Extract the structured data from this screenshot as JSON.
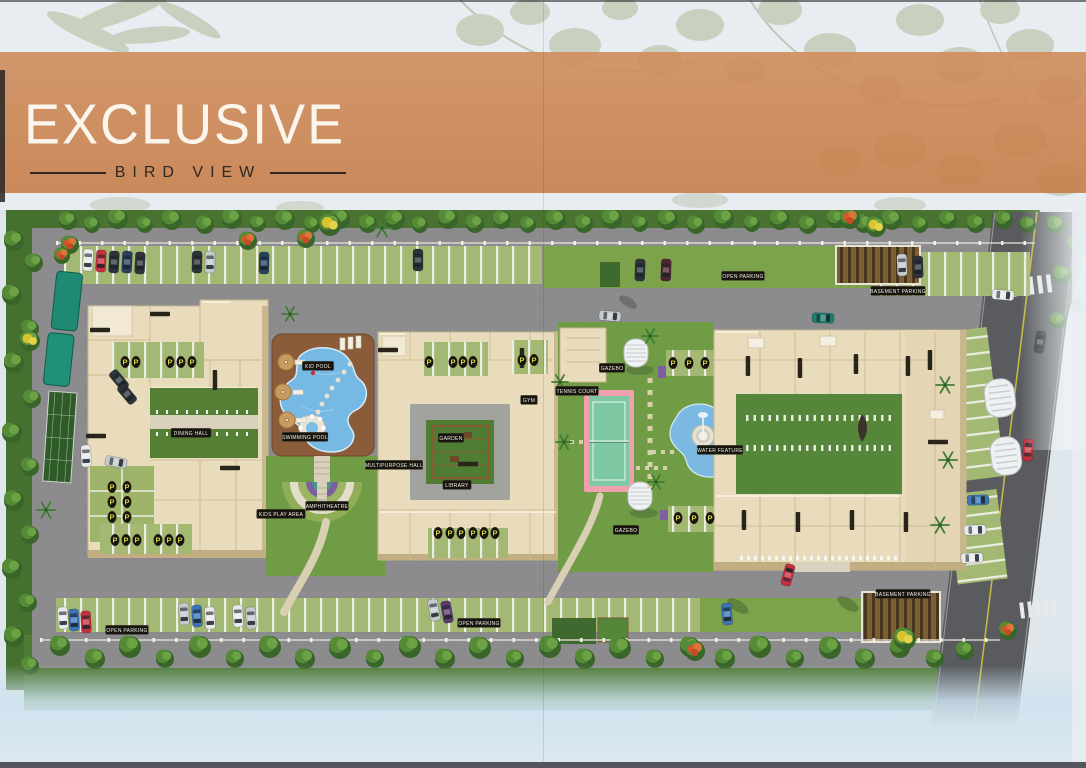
{
  "banner": {
    "title": "EXCLUSIVE",
    "subtitle": "BIRD VIEW"
  },
  "colors": {
    "banner_orange": "#cc8454",
    "label_bg": "#17150e",
    "parking_letter": "#d6d23f",
    "pool_blue": "#74b9e6",
    "lawn_green": "#6f9c45",
    "road_gray": "#595b5e",
    "pavement_gray": "#8d8d8f",
    "building_tan": "#e9dcbd"
  },
  "siteplan": {
    "parking_glyph": "P",
    "labels": [
      {
        "text": "OPEN PARKING",
        "x": 743,
        "y": 66
      },
      {
        "text": "BASEMENT PARKING",
        "x": 898,
        "y": 81
      },
      {
        "text": "OPEN PARKING",
        "x": 127,
        "y": 420
      },
      {
        "text": "OPEN PARKING",
        "x": 479,
        "y": 413
      },
      {
        "text": "BASEMENT PARKING",
        "x": 903,
        "y": 384
      },
      {
        "text": "KID POOL",
        "x": 318,
        "y": 156
      },
      {
        "text": "SWIMMING POOL",
        "x": 305,
        "y": 227
      },
      {
        "text": "AMPHITHEATRE",
        "x": 327,
        "y": 296
      },
      {
        "text": "KIDS PLAY AREA",
        "x": 281,
        "y": 304
      },
      {
        "text": "DINING HALL",
        "x": 191,
        "y": 223
      },
      {
        "text": "GARDEN",
        "x": 451,
        "y": 228
      },
      {
        "text": "GYM",
        "x": 529,
        "y": 190
      },
      {
        "text": "LIBRARY",
        "x": 457,
        "y": 275
      },
      {
        "text": "MULTIPURPOSE HALL",
        "x": 394,
        "y": 255
      },
      {
        "text": "TENNIS COURT",
        "x": 577,
        "y": 181
      },
      {
        "text": "GAZEBO",
        "x": 612,
        "y": 158
      },
      {
        "text": "GAZEBO",
        "x": 626,
        "y": 320
      },
      {
        "text": "WATER FEATURE",
        "x": 720,
        "y": 240
      }
    ],
    "p_markers": [
      [
        125,
        152
      ],
      [
        136,
        152
      ],
      [
        170,
        152
      ],
      [
        181,
        152
      ],
      [
        192,
        152
      ],
      [
        112,
        277
      ],
      [
        127,
        277
      ],
      [
        112,
        292
      ],
      [
        127,
        292
      ],
      [
        112,
        307
      ],
      [
        127,
        307
      ],
      [
        115,
        330
      ],
      [
        126,
        330
      ],
      [
        137,
        330
      ],
      [
        158,
        330
      ],
      [
        169,
        330
      ],
      [
        180,
        330
      ],
      [
        429,
        152
      ],
      [
        453,
        152
      ],
      [
        463,
        152
      ],
      [
        473,
        152
      ],
      [
        522,
        150
      ],
      [
        534,
        150
      ],
      [
        438,
        323
      ],
      [
        450,
        323
      ],
      [
        461,
        323
      ],
      [
        473,
        323
      ],
      [
        484,
        323
      ],
      [
        495,
        323
      ],
      [
        673,
        153
      ],
      [
        689,
        153
      ],
      [
        705,
        153
      ],
      [
        678,
        308
      ],
      [
        694,
        308
      ],
      [
        710,
        308
      ]
    ],
    "cars": [
      [
        88,
        50,
        183,
        "w"
      ],
      [
        101,
        51,
        183,
        "r"
      ],
      [
        114,
        52,
        183,
        "d"
      ],
      [
        127,
        52,
        183,
        "n"
      ],
      [
        140,
        53,
        183,
        "d"
      ],
      [
        197,
        52,
        181,
        "d"
      ],
      [
        210,
        52,
        181,
        "s"
      ],
      [
        264,
        53,
        181,
        "n"
      ],
      [
        418,
        50,
        180,
        "d"
      ],
      [
        640,
        60,
        182,
        "d"
      ],
      [
        666,
        60,
        182,
        "m"
      ],
      [
        902,
        55,
        178,
        "s"
      ],
      [
        918,
        57,
        178,
        "d"
      ],
      [
        1003,
        85,
        95,
        "w"
      ],
      [
        86,
        246,
        178,
        "w"
      ],
      [
        116,
        252,
        100,
        "s"
      ],
      [
        119,
        170,
        140,
        "d"
      ],
      [
        127,
        184,
        140,
        "d"
      ],
      [
        610,
        106,
        95,
        "s"
      ],
      [
        823,
        108,
        92,
        "t"
      ],
      [
        63,
        408,
        177,
        "w"
      ],
      [
        74,
        410,
        177,
        "b"
      ],
      [
        86,
        412,
        177,
        "r"
      ],
      [
        184,
        404,
        177,
        "s"
      ],
      [
        197,
        406,
        177,
        "b"
      ],
      [
        210,
        408,
        177,
        "w"
      ],
      [
        238,
        406,
        177,
        "w"
      ],
      [
        251,
        408,
        177,
        "s"
      ],
      [
        434,
        400,
        170,
        "s"
      ],
      [
        447,
        402,
        170,
        "p"
      ],
      [
        727,
        404,
        175,
        "b"
      ],
      [
        978,
        290,
        88,
        "b"
      ],
      [
        975,
        320,
        88,
        "w"
      ],
      [
        972,
        348,
        88,
        "w"
      ],
      [
        1040,
        132,
        8,
        "d"
      ],
      [
        1028,
        240,
        5,
        "r"
      ],
      [
        788,
        365,
        15,
        "r"
      ]
    ],
    "trees": [
      [
        68,
        10,
        9,
        "g"
      ],
      [
        92,
        14,
        8,
        "g"
      ],
      [
        118,
        8,
        10,
        "g"
      ],
      [
        145,
        14,
        8,
        "g"
      ],
      [
        172,
        9,
        10,
        "g"
      ],
      [
        205,
        14,
        9,
        "g"
      ],
      [
        232,
        8,
        10,
        "g"
      ],
      [
        258,
        13,
        8,
        "g"
      ],
      [
        285,
        9,
        10,
        "g"
      ],
      [
        312,
        14,
        8,
        "g"
      ],
      [
        340,
        8,
        10,
        "g"
      ],
      [
        368,
        13,
        9,
        "g"
      ],
      [
        395,
        9,
        10,
        "g"
      ],
      [
        420,
        14,
        8,
        "g"
      ],
      [
        448,
        8,
        10,
        "g"
      ],
      [
        475,
        13,
        9,
        "g"
      ],
      [
        502,
        9,
        9,
        "g"
      ],
      [
        528,
        14,
        8,
        "g"
      ],
      [
        556,
        9,
        10,
        "g"
      ],
      [
        584,
        13,
        9,
        "g"
      ],
      [
        612,
        8,
        10,
        "g"
      ],
      [
        640,
        13,
        8,
        "g"
      ],
      [
        668,
        9,
        10,
        "g"
      ],
      [
        696,
        14,
        9,
        "g"
      ],
      [
        724,
        8,
        10,
        "g"
      ],
      [
        752,
        13,
        8,
        "g"
      ],
      [
        780,
        9,
        10,
        "g"
      ],
      [
        808,
        14,
        9,
        "g"
      ],
      [
        836,
        8,
        9,
        "g"
      ],
      [
        864,
        13,
        9,
        "g"
      ],
      [
        892,
        9,
        10,
        "g"
      ],
      [
        920,
        14,
        8,
        "g"
      ],
      [
        948,
        9,
        9,
        "g"
      ],
      [
        976,
        13,
        9,
        "g"
      ],
      [
        1004,
        9,
        9,
        "g"
      ],
      [
        1028,
        14,
        8,
        "g"
      ],
      [
        70,
        34,
        9,
        "o"
      ],
      [
        248,
        30,
        9,
        "o"
      ],
      [
        306,
        28,
        9,
        "o"
      ],
      [
        850,
        8,
        10,
        "o"
      ],
      [
        62,
        45,
        8,
        "o"
      ],
      [
        330,
        14,
        11,
        "y"
      ],
      [
        876,
        16,
        10,
        "y"
      ],
      [
        382,
        18,
        10,
        "p"
      ],
      [
        14,
        30,
        10,
        "g"
      ],
      [
        34,
        52,
        9,
        "g"
      ],
      [
        12,
        84,
        10,
        "g"
      ],
      [
        30,
        118,
        9,
        "g"
      ],
      [
        14,
        152,
        10,
        "g"
      ],
      [
        32,
        188,
        9,
        "g"
      ],
      [
        12,
        222,
        10,
        "g"
      ],
      [
        30,
        256,
        9,
        "g"
      ],
      [
        14,
        290,
        10,
        "g"
      ],
      [
        30,
        324,
        9,
        "g"
      ],
      [
        12,
        358,
        10,
        "g"
      ],
      [
        28,
        392,
        9,
        "g"
      ],
      [
        14,
        426,
        10,
        "g"
      ],
      [
        30,
        455,
        9,
        "g"
      ],
      [
        30,
        130,
        10,
        "y"
      ],
      [
        46,
        300,
        9,
        "p"
      ],
      [
        60,
        435,
        10,
        "g"
      ],
      [
        95,
        448,
        10,
        "g"
      ],
      [
        130,
        436,
        11,
        "g"
      ],
      [
        165,
        448,
        9,
        "g"
      ],
      [
        200,
        436,
        11,
        "g"
      ],
      [
        235,
        448,
        9,
        "g"
      ],
      [
        270,
        436,
        11,
        "g"
      ],
      [
        305,
        448,
        10,
        "g"
      ],
      [
        340,
        437,
        11,
        "g"
      ],
      [
        375,
        448,
        9,
        "g"
      ],
      [
        410,
        436,
        11,
        "g"
      ],
      [
        445,
        448,
        10,
        "g"
      ],
      [
        480,
        437,
        11,
        "g"
      ],
      [
        515,
        448,
        9,
        "g"
      ],
      [
        550,
        436,
        11,
        "g"
      ],
      [
        585,
        448,
        10,
        "g"
      ],
      [
        620,
        437,
        11,
        "g"
      ],
      [
        655,
        448,
        9,
        "g"
      ],
      [
        690,
        436,
        10,
        "g"
      ],
      [
        725,
        448,
        10,
        "g"
      ],
      [
        760,
        436,
        11,
        "g"
      ],
      [
        795,
        448,
        9,
        "g"
      ],
      [
        830,
        437,
        11,
        "g"
      ],
      [
        865,
        448,
        10,
        "g"
      ],
      [
        900,
        437,
        10,
        "g"
      ],
      [
        935,
        448,
        9,
        "g"
      ],
      [
        965,
        440,
        9,
        "g"
      ],
      [
        695,
        440,
        10,
        "o"
      ],
      [
        1008,
        420,
        9,
        "o"
      ],
      [
        905,
        428,
        11,
        "y"
      ],
      [
        290,
        104,
        8,
        "p"
      ],
      [
        560,
        172,
        8,
        "p"
      ],
      [
        564,
        232,
        8,
        "p"
      ],
      [
        650,
        126,
        8,
        "p"
      ],
      [
        656,
        272,
        8,
        "p"
      ],
      [
        945,
        175,
        9,
        "p"
      ],
      [
        948,
        250,
        9,
        "p"
      ],
      [
        940,
        315,
        9,
        "p"
      ],
      [
        1056,
        14,
        9,
        "g"
      ],
      [
        1075,
        34,
        8,
        "g"
      ],
      [
        1062,
        64,
        9,
        "g"
      ],
      [
        1080,
        95,
        8,
        "g"
      ],
      [
        1058,
        110,
        8,
        "g"
      ],
      [
        738,
        396,
        12,
        "sh"
      ],
      [
        848,
        394,
        12,
        "sh"
      ],
      [
        628,
        92,
        10,
        "sh"
      ]
    ],
    "roof_strips": [
      [
        100,
        120,
        0
      ],
      [
        160,
        104,
        0
      ],
      [
        96,
        226,
        0
      ],
      [
        215,
        170,
        90
      ],
      [
        230,
        258,
        0
      ],
      [
        388,
        140,
        0
      ],
      [
        522,
        148,
        90
      ],
      [
        396,
        254,
        0
      ],
      [
        468,
        254,
        0
      ],
      [
        748,
        156,
        90
      ],
      [
        800,
        158,
        90
      ],
      [
        856,
        154,
        90
      ],
      [
        908,
        156,
        90
      ],
      [
        744,
        310,
        90
      ],
      [
        798,
        312,
        90
      ],
      [
        852,
        310,
        90
      ],
      [
        906,
        312,
        90
      ],
      [
        938,
        232,
        0
      ],
      [
        930,
        150,
        90
      ]
    ]
  }
}
